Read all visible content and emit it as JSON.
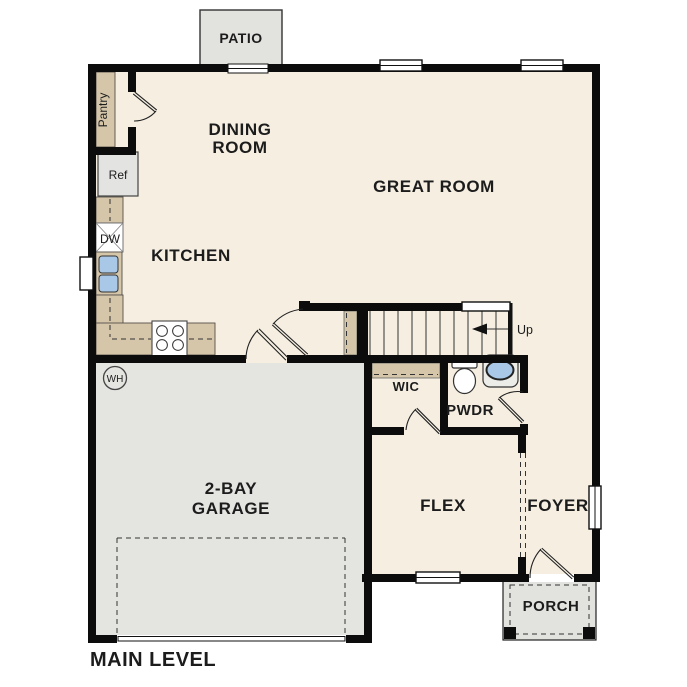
{
  "title": "MAIN LEVEL",
  "colors": {
    "wall": "#0c0c0c",
    "floor": "#f5eee1",
    "garage_floor": "#e4e4e1",
    "patio": "#e2e2df",
    "porch": "#e2e2df",
    "counter": "#d5c6aa",
    "water": "#a9c7e6",
    "text": "#1c1c1c"
  },
  "labels": {
    "patio": "PATIO",
    "pantry": "Pantry",
    "dining_room_line1": "DINING",
    "dining_room_line2": "ROOM",
    "great_room": "GREAT ROOM",
    "kitchen": "KITCHEN",
    "refrigerator": "Ref",
    "dishwasher": "DW",
    "water_heater": "WH",
    "garage_line1": "2-BAY",
    "garage_line2": "GARAGE",
    "stairs_direction": "Up",
    "wic": "WIC",
    "powder_room": "PWDR",
    "flex": "FLEX",
    "foyer": "FOYER",
    "porch": "PORCH",
    "level_title": "MAIN LEVEL"
  }
}
